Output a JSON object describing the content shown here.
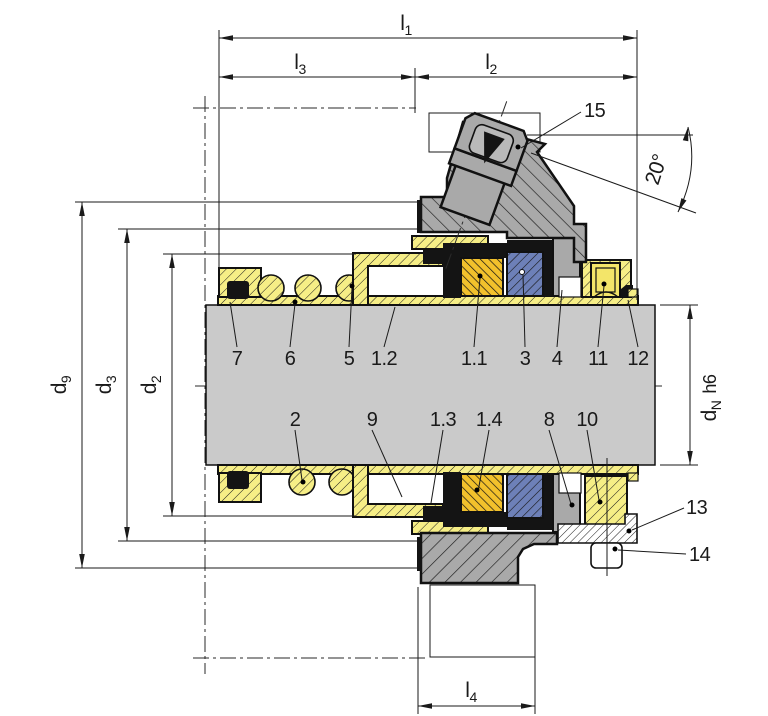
{
  "drawing": {
    "title": "mechanical-seal-cross-section",
    "dims": {
      "l1": {
        "base": "l",
        "sub": "1"
      },
      "l2": {
        "base": "l",
        "sub": "2"
      },
      "l3": {
        "base": "l",
        "sub": "3"
      },
      "l4": {
        "base": "l",
        "sub": "4"
      },
      "d9": {
        "base": "d",
        "sub": "9"
      },
      "d3": {
        "base": "d",
        "sub": "3"
      },
      "d2": {
        "base": "d",
        "sub": "2"
      },
      "dN": {
        "base": "d",
        "sub": "N",
        "tol": "h6"
      },
      "angle": "20°"
    },
    "parts": {
      "n7": "7",
      "n6": "6",
      "n5": "5",
      "n1_2": "1.2",
      "n1_1": "1.1",
      "n3": "3",
      "n4": "4",
      "n11": "11",
      "n12": "12",
      "n2": "2",
      "n9": "9",
      "n1_3": "1.3",
      "n1_4": "1.4",
      "n8": "8",
      "n10": "10",
      "n13": "13",
      "n14": "14",
      "n15": "15"
    },
    "colors": {
      "shaft": "#cacaca",
      "housing_gray": "#a9a9a9",
      "sleeve_yellow": "#f6ee86",
      "face_gold": "#f2c12c",
      "seat_blue": "#6d80b8",
      "elastomer_black": "#141414",
      "line": "#1a1a1a"
    }
  }
}
